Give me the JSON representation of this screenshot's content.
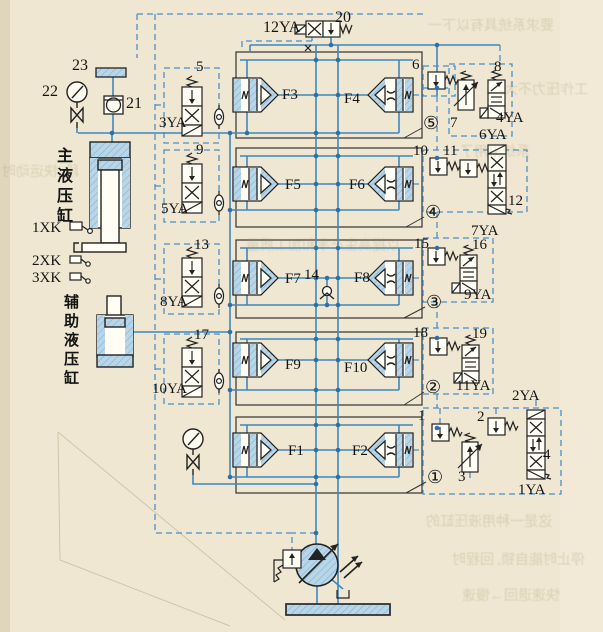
{
  "labels": {
    "ya12": "12YA",
    "n20": "20",
    "n23": "23",
    "n22": "22",
    "n21": "21",
    "n5": "5",
    "ya3": "3YA",
    "n9": "9",
    "ya5": "5YA",
    "n13": "13",
    "ya8": "8YA",
    "n17": "17",
    "ya10": "10YA",
    "f1": "F1",
    "f2": "F2",
    "f3": "F3",
    "f4": "F4",
    "f5": "F5",
    "f6": "F6",
    "f7": "F7",
    "f8": "F8",
    "f9": "F9",
    "f10": "F10",
    "n6": "6",
    "n7": "7",
    "n8": "8",
    "ya4": "4YA",
    "ya6": "6YA",
    "n10": "10",
    "n11": "11",
    "n12": "12",
    "ya7": "7YA",
    "n14": "14",
    "n15": "15",
    "n16": "16",
    "ya9": "9YA",
    "n18": "18",
    "n19": "19",
    "ya11": "11YA",
    "n1": "1",
    "n2": "2",
    "ya2": "2YA",
    "n3": "3",
    "n4": "4",
    "ya1": "1YA",
    "c5": "⑤",
    "c4": "④",
    "c3": "③",
    "c2": "②",
    "c1": "①",
    "main_cylinder": "主液压缸",
    "aux_cylinder": "辅助液压缸",
    "xk1": "1XK",
    "xk2": "2XK",
    "xk3": "3XK"
  },
  "colors": {
    "paper": "#ece3cc",
    "pipe_blue": "#3f87c0",
    "fill_blue": "#b8d6e8",
    "hatch_blue": "#7fb0d0",
    "component_black": "#222222",
    "junction_dot": "#2f6ea6"
  },
  "bleed": [
    "要求系统具有以下一",
    "工作压力不大。",
    "系统采用了",
    "段, 快运动时",
    "以提高生产率和加工质量",
    "这是一种用液压缸的",
    "停止时能自锁, 回程时",
    "快速退回→慢速"
  ]
}
